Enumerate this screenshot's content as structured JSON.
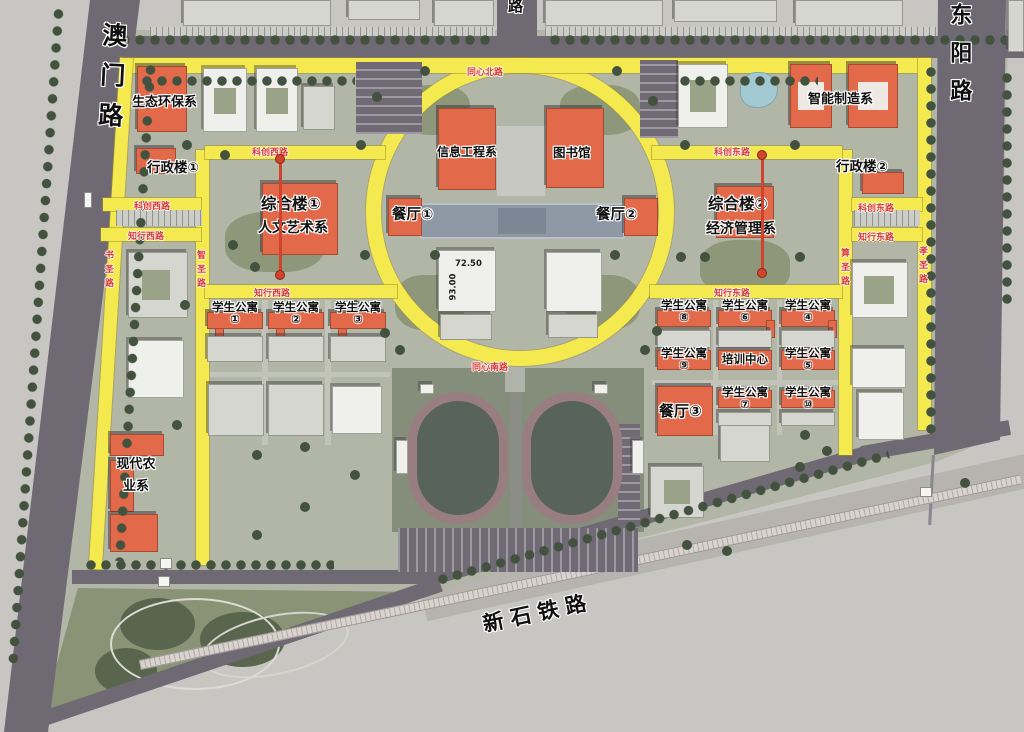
{
  "roads": {
    "aomen": "澳门路",
    "dongyang": "东阳路",
    "top_partial": "路",
    "railway": "新石铁路",
    "tongxin_north": "同心北路",
    "tongxin_south": "同心南路",
    "kechuang_west": "科创西路",
    "kechuang_east": "科创东路",
    "zhixing_west": "知行西路",
    "zhixing_east": "知行东路",
    "shusheng": "书圣路",
    "zhisheng": "智圣路",
    "suansheng": "算圣路",
    "xiaosheng": "孝圣路"
  },
  "buildings": {
    "eco": "生态环保系",
    "admin1": "行政楼①",
    "admin2": "行政楼②",
    "complex1": "综合楼①",
    "humanities": "人文艺术系",
    "complex2": "综合楼②",
    "economics": "经济管理系",
    "info_engineering": "信息工程系",
    "library": "图书馆",
    "canteen1": "餐厅①",
    "canteen2": "餐厅②",
    "canteen3": "餐厅③",
    "smart_mfg": "智能制造系",
    "modern_agri": "现代农业系",
    "training_center": "培训中心",
    "dorm_label": "学生公寓",
    "dorm_numbers": [
      "①",
      "②",
      "③",
      "④",
      "⑤",
      "⑥",
      "⑦",
      "⑧",
      "⑨",
      "⑩"
    ]
  },
  "elevations": [
    "72.50",
    "93.00"
  ],
  "colors": {
    "road_yellow": "#f4e94e",
    "label_red": "#d9382e",
    "building_orange": "#e2694a"
  }
}
